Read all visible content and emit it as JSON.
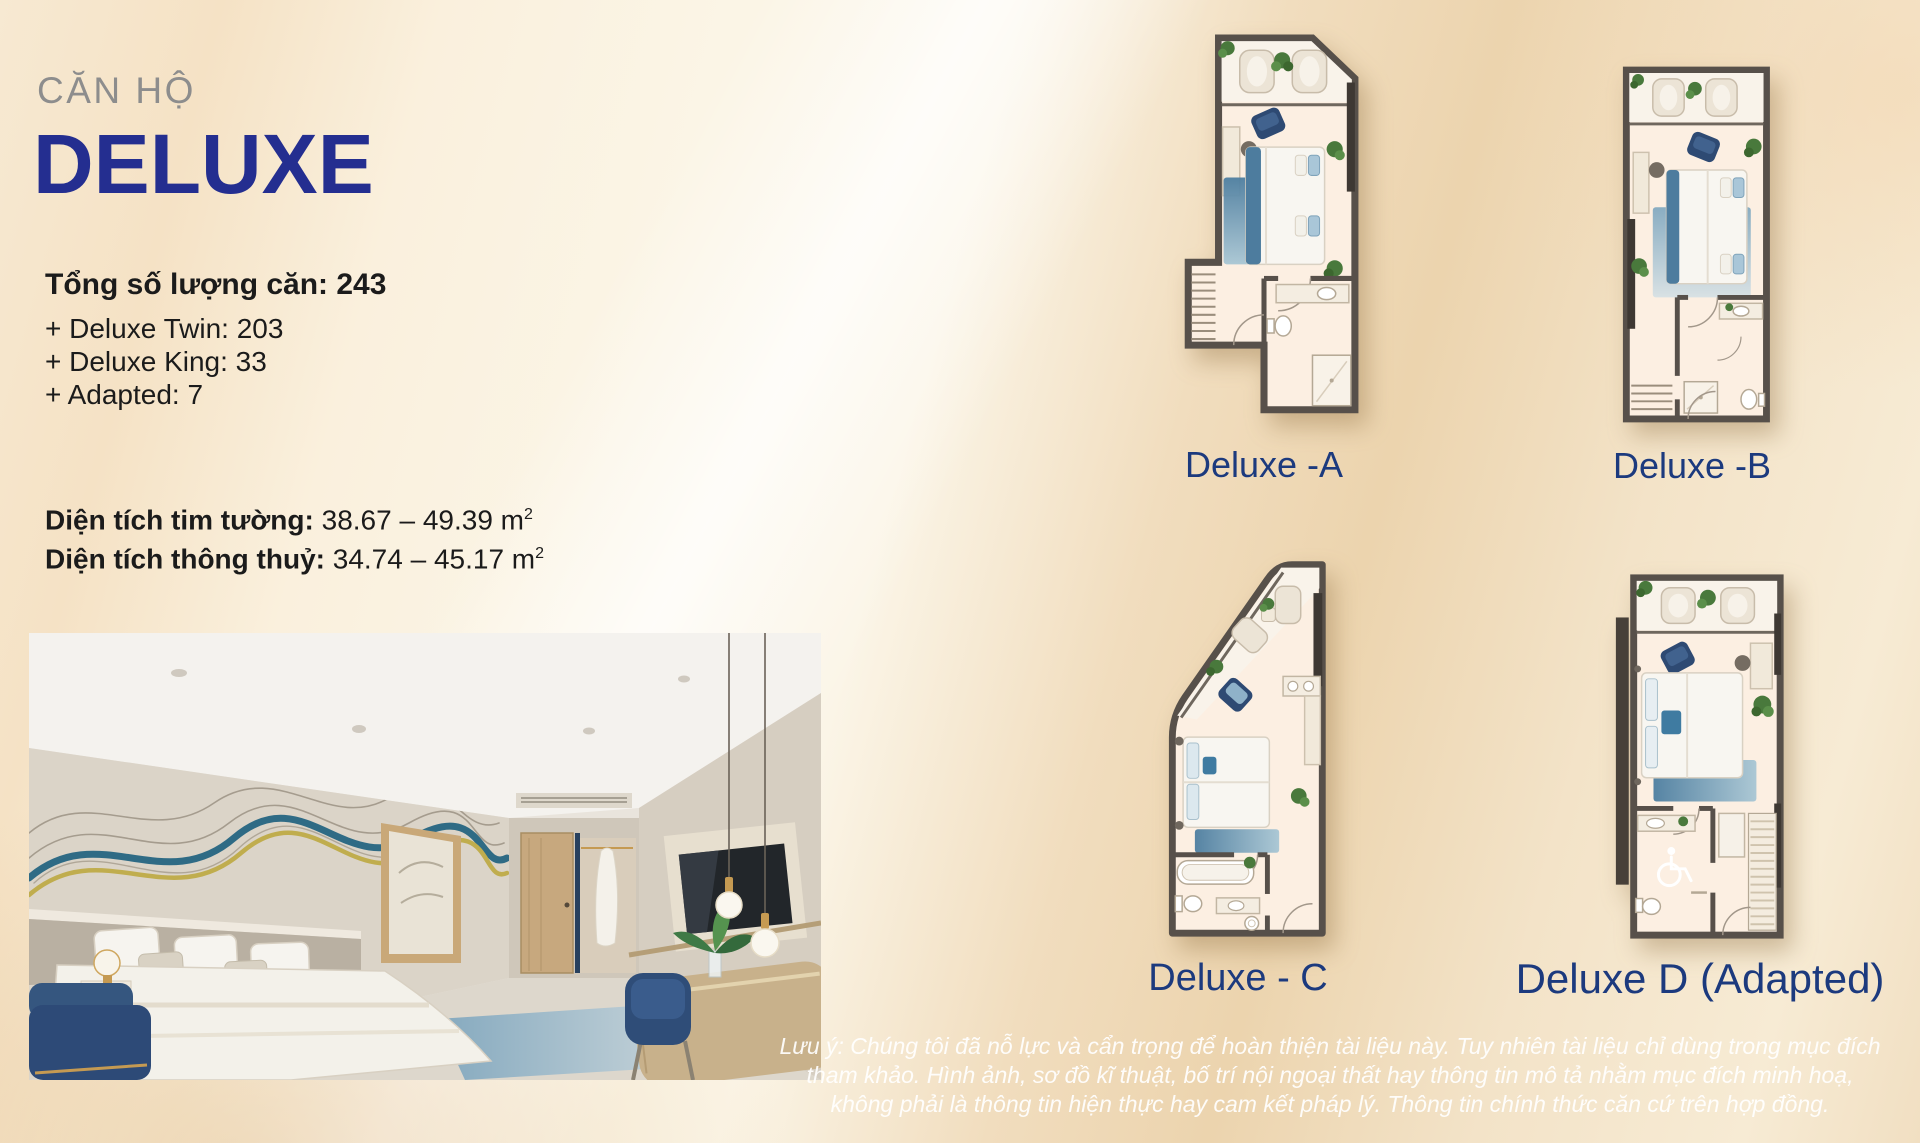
{
  "page": {
    "eyebrow": "CĂN HỘ",
    "title": "DELUXE",
    "stats": {
      "total": "Tổng số lượng căn: 243",
      "items": [
        "+ Deluxe Twin: 203",
        "+ Deluxe King: 33",
        "+ Adapted: 7"
      ]
    },
    "areas": [
      {
        "label": "Diện tích tim tường:",
        "value": " 38.67 – 49.39 m",
        "sup": "2"
      },
      {
        "label": "Diện tích thông thuỷ:",
        "value": " 34.74 – 45.17 m",
        "sup": "2"
      }
    ],
    "plans": [
      {
        "id": "a",
        "label": "Deluxe -A"
      },
      {
        "id": "b",
        "label": "Deluxe -B"
      },
      {
        "id": "c",
        "label": "Deluxe - C"
      },
      {
        "id": "d",
        "label": "Deluxe D (Adapted)"
      }
    ],
    "disclaimer": {
      "line1": "Lưu ý: Chúng tôi đã nỗ lực và cẩn trọng để hoàn thiện tài liệu này. Tuy nhiên tài liệu chỉ dùng trong mục đích",
      "line2": "tham khảo. Hình ảnh, sơ đồ kĩ thuật, bố trí nội ngoại thất hay thông tin mô tả nhằm mục đích minh hoạ,",
      "line3": "không phải là thông tin hiện thực hay cam kết pháp lý. Thông tin chính thức căn cứ trên hợp đồng."
    },
    "colors": {
      "title_navy": "#242e90",
      "plan_label_blue": "#1c3a7e",
      "eyebrow_gray": "#8d8d8d",
      "background_cream": "#f6e8d0",
      "wall_gray": "#57504a",
      "rug_blue": "#5d8cab"
    }
  }
}
